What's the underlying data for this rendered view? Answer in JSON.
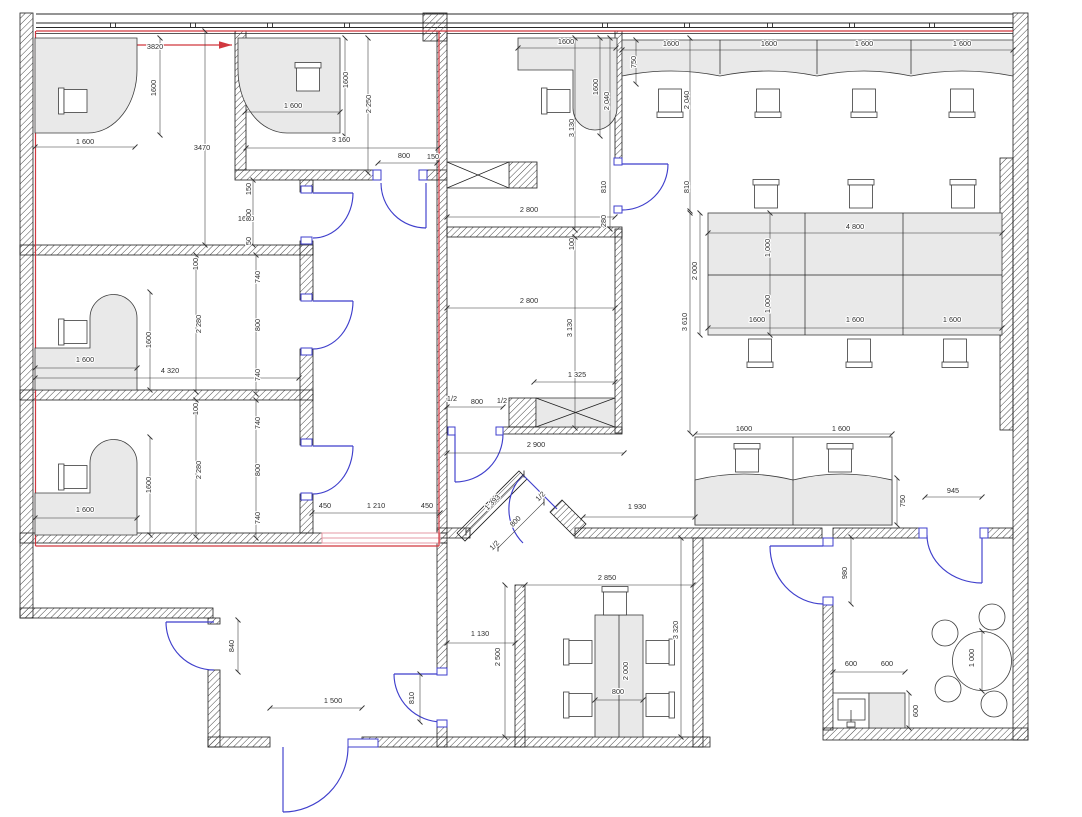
{
  "title": "Office floor plan CAD drawing",
  "colors": {
    "wall_outline": "#1f1f1f",
    "hatch": "#4a4a4a",
    "door_blue": "#3f3fcc",
    "accent_red": "#d1383f",
    "window_pink": "#e59aa4",
    "furniture_fill": "#e9e9e9",
    "dim_text": "#2e2e2e",
    "background": "#ffffff"
  },
  "annotations": {
    "red_span_label": "3820",
    "room_width_label": "3470",
    "corridor_label": "1600"
  },
  "dim_labels": [
    {
      "t": "3820",
      "x": 155,
      "y": 49,
      "s": 15
    },
    {
      "t": "3470",
      "x": 202,
      "y": 150,
      "s": 15
    },
    {
      "t": "1600",
      "x": 246,
      "y": 221,
      "s": 15
    },
    {
      "t": "1600",
      "x": 156,
      "y": 88,
      "r": -90
    },
    {
      "t": "1 600",
      "x": 85,
      "y": 144
    },
    {
      "t": "1 600",
      "x": 293,
      "y": 108
    },
    {
      "t": "1600",
      "x": 348,
      "y": 80,
      "r": -90
    },
    {
      "t": "2 250",
      "x": 371,
      "y": 104,
      "r": -90
    },
    {
      "t": "3 160",
      "x": 341,
      "y": 142
    },
    {
      "t": "800",
      "x": 404,
      "y": 158
    },
    {
      "t": "150",
      "x": 433,
      "y": 159
    },
    {
      "t": "150",
      "x": 251,
      "y": 189,
      "r": -90
    },
    {
      "t": "800",
      "x": 251,
      "y": 215,
      "r": -90
    },
    {
      "t": "50",
      "x": 251,
      "y": 241,
      "r": -90
    },
    {
      "t": "100",
      "x": 198,
      "y": 264,
      "r": -90
    },
    {
      "t": "740",
      "x": 260,
      "y": 277,
      "r": -90
    },
    {
      "t": "2 280",
      "x": 201,
      "y": 324,
      "r": -90
    },
    {
      "t": "800",
      "x": 260,
      "y": 325,
      "r": -90
    },
    {
      "t": "1600",
      "x": 151,
      "y": 340,
      "r": -90
    },
    {
      "t": "1 600",
      "x": 85,
      "y": 362
    },
    {
      "t": "4 320",
      "x": 170,
      "y": 373
    },
    {
      "t": "740",
      "x": 260,
      "y": 375,
      "r": -90
    },
    {
      "t": "100",
      "x": 198,
      "y": 409,
      "r": -90
    },
    {
      "t": "740",
      "x": 260,
      "y": 423,
      "r": -90
    },
    {
      "t": "2 280",
      "x": 201,
      "y": 470,
      "r": -90
    },
    {
      "t": "800",
      "x": 260,
      "y": 470,
      "r": -90
    },
    {
      "t": "1600",
      "x": 151,
      "y": 485,
      "r": -90
    },
    {
      "t": "1 600",
      "x": 85,
      "y": 512
    },
    {
      "t": "740",
      "x": 260,
      "y": 518,
      "r": -90
    },
    {
      "t": "450",
      "x": 325,
      "y": 508
    },
    {
      "t": "1 210",
      "x": 376,
      "y": 508
    },
    {
      "t": "450",
      "x": 427,
      "y": 508
    },
    {
      "t": "1600",
      "x": 566,
      "y": 44
    },
    {
      "t": "750",
      "x": 636,
      "y": 62,
      "r": -90
    },
    {
      "t": "1600",
      "x": 598,
      "y": 87,
      "r": -90
    },
    {
      "t": "2 040",
      "x": 609,
      "y": 101,
      "r": -90
    },
    {
      "t": "3 130",
      "x": 574,
      "y": 128,
      "r": -90
    },
    {
      "t": "2 040",
      "x": 689,
      "y": 100,
      "r": -90
    },
    {
      "t": "810",
      "x": 606,
      "y": 187,
      "r": -90
    },
    {
      "t": "810",
      "x": 689,
      "y": 187,
      "r": -90
    },
    {
      "t": "2 800",
      "x": 529,
      "y": 212
    },
    {
      "t": "280",
      "x": 606,
      "y": 221,
      "r": -90
    },
    {
      "t": "100",
      "x": 574,
      "y": 244,
      "r": -90
    },
    {
      "t": "2 800",
      "x": 529,
      "y": 303
    },
    {
      "t": "3 130",
      "x": 572,
      "y": 328,
      "r": -90
    },
    {
      "t": "1 325",
      "x": 577,
      "y": 377
    },
    {
      "t": "1/2",
      "x": 452,
      "y": 401
    },
    {
      "t": "800",
      "x": 477,
      "y": 404
    },
    {
      "t": "1/2",
      "x": 502,
      "y": 403
    },
    {
      "t": "2 900",
      "x": 536,
      "y": 447
    },
    {
      "t": "1600",
      "x": 671,
      "y": 46
    },
    {
      "t": "1600",
      "x": 769,
      "y": 46
    },
    {
      "t": "1 600",
      "x": 864,
      "y": 46
    },
    {
      "t": "1 600",
      "x": 962,
      "y": 46
    },
    {
      "t": "4 800",
      "x": 855,
      "y": 229
    },
    {
      "t": "2 000",
      "x": 697,
      "y": 271,
      "r": -90
    },
    {
      "t": "1 000",
      "x": 770,
      "y": 248,
      "r": -90
    },
    {
      "t": "1 000",
      "x": 770,
      "y": 304,
      "r": -90
    },
    {
      "t": "3 610",
      "x": 687,
      "y": 322,
      "r": -90
    },
    {
      "t": "1600",
      "x": 757,
      "y": 322
    },
    {
      "t": "1 600",
      "x": 855,
      "y": 322
    },
    {
      "t": "1 600",
      "x": 952,
      "y": 322
    },
    {
      "t": "1600",
      "x": 744,
      "y": 431
    },
    {
      "t": "1 600",
      "x": 841,
      "y": 431
    },
    {
      "t": "750",
      "x": 905,
      "y": 501,
      "r": -90
    },
    {
      "t": "1 930",
      "x": 637,
      "y": 509
    },
    {
      "t": "945",
      "x": 953,
      "y": 493
    },
    {
      "t": "980",
      "x": 847,
      "y": 573,
      "r": -90
    },
    {
      "t": "600",
      "x": 851,
      "y": 666
    },
    {
      "t": "600",
      "x": 887,
      "y": 666
    },
    {
      "t": "600",
      "x": 918,
      "y": 711,
      "r": -90
    },
    {
      "t": "1 000",
      "x": 974,
      "y": 658,
      "r": -90
    },
    {
      "t": "2 850",
      "x": 607,
      "y": 580
    },
    {
      "t": "3 320",
      "x": 678,
      "y": 630,
      "r": -90
    },
    {
      "t": "2 000",
      "x": 628,
      "y": 671,
      "r": -90
    },
    {
      "t": "800",
      "x": 618,
      "y": 694
    },
    {
      "t": "2 500",
      "x": 500,
      "y": 657,
      "r": -90
    },
    {
      "t": "1 130",
      "x": 480,
      "y": 636
    },
    {
      "t": "1 393",
      "x": 494,
      "y": 504,
      "r": -45
    },
    {
      "t": "1/2",
      "x": 542,
      "y": 498,
      "r": -45
    },
    {
      "t": "800",
      "x": 517,
      "y": 523,
      "r": -45
    },
    {
      "t": "1/2",
      "x": 496,
      "y": 547,
      "r": -45
    },
    {
      "t": "840",
      "x": 234,
      "y": 646,
      "r": -90
    },
    {
      "t": "1 500",
      "x": 333,
      "y": 703
    },
    {
      "t": "810",
      "x": 414,
      "y": 698,
      "r": -90
    }
  ],
  "window_mullions_x": [
    113,
    193,
    270,
    347,
    605,
    687,
    770,
    852,
    932
  ]
}
